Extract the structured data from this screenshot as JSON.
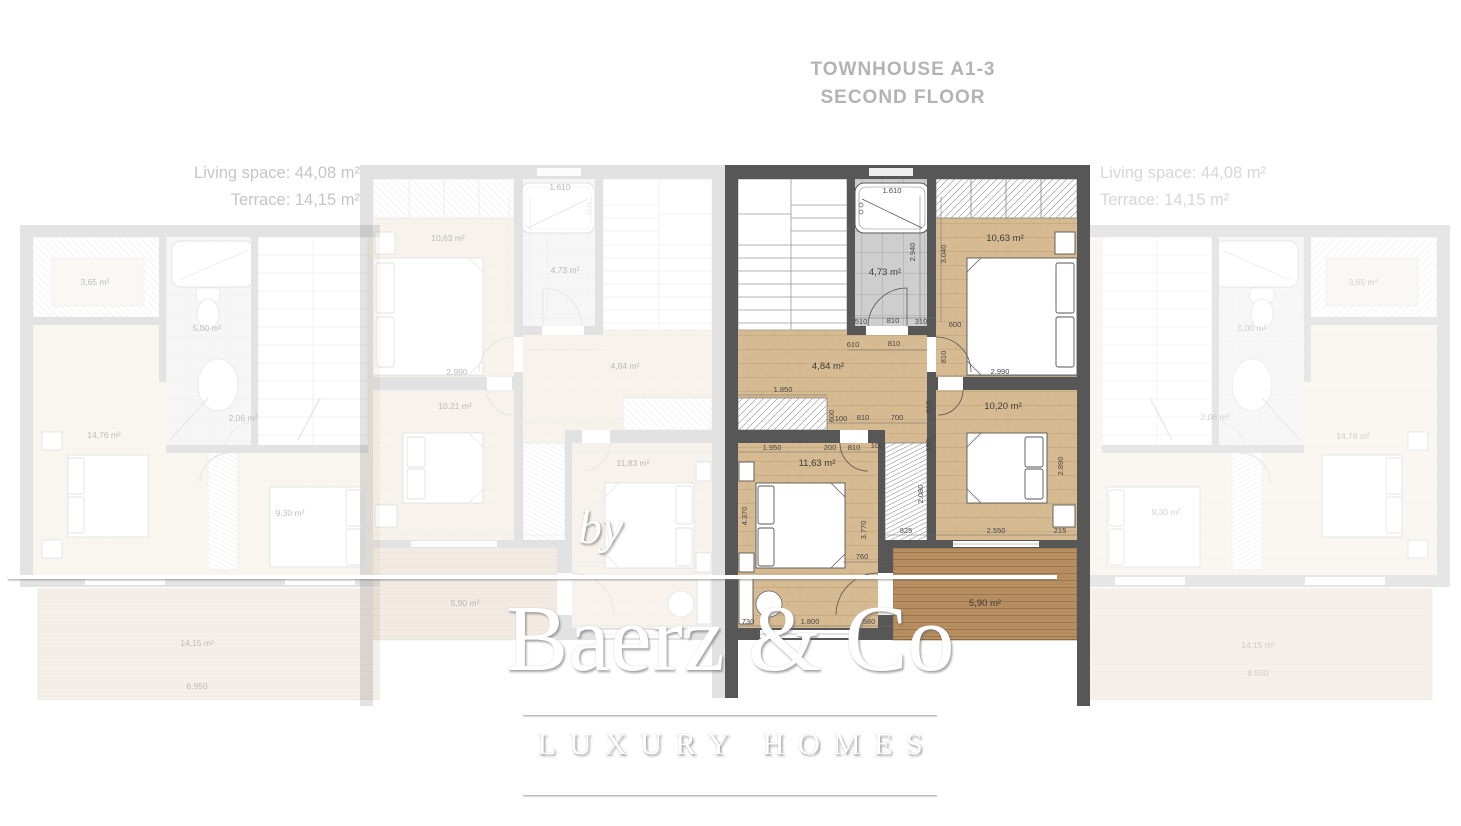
{
  "header": {
    "title_line1": "TOWNHOUSE A1-3",
    "title_line2": "SECOND FLOOR"
  },
  "info_left": {
    "living_space": "Living space: 44,08 m²",
    "terrace": "Terrace: 14,15 m²"
  },
  "info_right": {
    "living_space": "Living space: 44,08 m²",
    "terrace": "Terrace: 14,15 m²"
  },
  "watermark": {
    "prefix": "by",
    "brand": "Baerz & Co",
    "tagline": "LUXURY HOMES"
  },
  "central_plan": {
    "rooms": {
      "bathroom": "4,73 m²",
      "bedroom_top": "10,63 m²",
      "hallway": "4,84 m²",
      "bedroom_mid": "10,20 m²",
      "bedroom_left": "11,63 m²",
      "terrace": "5,90 m²"
    },
    "dims": {
      "tub": "1.610",
      "bath_a": "510",
      "bath_b": "810",
      "bath_c": "310",
      "bath_h": "2.940",
      "bedtop_h": "3.040",
      "bedtop_off": "600",
      "hall_a": "610",
      "hall_b": "810",
      "door_top": "810",
      "sep": "2.990",
      "ward_w": "1.850",
      "ward_d": "600",
      "hall_c": "100",
      "hall_d": "810",
      "hall_e": "700",
      "door_mid": "810",
      "seg": "100",
      "bl_a": "1.950",
      "bl_b": "200",
      "bl_c": "810",
      "bl_d": "100",
      "bl_h": "4.370",
      "bl_m": "3.770",
      "bl_e": "760",
      "bl_f": "730",
      "closet_w": "825",
      "closet_h": "2.080",
      "bm_a": "2.550",
      "bm_b": "215",
      "bm_h": "2.890",
      "bot_a": "1.800",
      "bot_b": "580"
    }
  },
  "side_units": {
    "mid_left": {
      "bedroom_top": "10,63 m²",
      "bathroom": "4,73 m²",
      "tub": "1.610",
      "hallway": "4,84 m²",
      "bedroom_mid": "10,21 m²",
      "bedroom_left": "11,83 m²",
      "terrace": "5,90 m²",
      "sep": "2.990"
    },
    "far_left": {
      "closet": "3,65 m²",
      "bathroom": "5,00 m²",
      "hall": "2,06 m²",
      "bedroom_big": "14,76 m²",
      "bedroom_small": "9,30 m²",
      "terrace": "14,15 m²",
      "terrace_w": "6.950"
    },
    "far_right": {
      "closet": "3,65 m²",
      "bathroom": "5,00 m²",
      "hall": "2,06 m²",
      "bedroom_big": "14,76 m²",
      "bedroom_small": "9,30 m²",
      "terrace": "14,15 m²",
      "terrace_w": "8.550"
    }
  },
  "colors": {
    "wall": "#575757",
    "wood_floor": "#d6ba92",
    "deck": "#b88f61",
    "tile": "#cecece",
    "title_text": "#b3b3b3"
  }
}
